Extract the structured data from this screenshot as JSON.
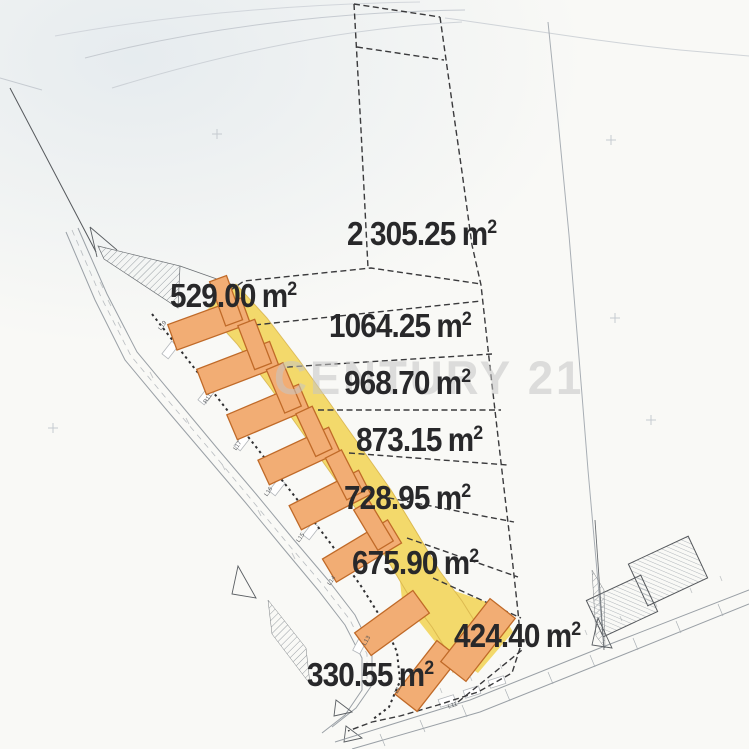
{
  "watermark": {
    "text": "CENTURY 21"
  },
  "units": {
    "base": "m",
    "exp": "2"
  },
  "parcels": [
    {
      "name": "parcel-2305",
      "area": "2 305.25"
    },
    {
      "name": "parcel-529",
      "area": "529.00"
    },
    {
      "name": "parcel-1064",
      "area": "1064.25"
    },
    {
      "name": "parcel-968",
      "area": "968.70"
    },
    {
      "name": "parcel-873",
      "area": "873.15"
    },
    {
      "name": "parcel-728",
      "area": "728.95"
    },
    {
      "name": "parcel-675",
      "area": "675.90"
    },
    {
      "name": "parcel-424",
      "area": "424.40"
    },
    {
      "name": "parcel-330",
      "area": "330.55"
    }
  ],
  "survey_points": [
    "L19",
    "R11",
    "L17",
    "L16",
    "L15",
    "L14",
    "L13",
    "L12",
    "L11"
  ],
  "colors": {
    "access_band": "#f3d96b",
    "band_edge": "#c79b36",
    "house_fill": "#f2ad74",
    "house_stroke": "#c06a28",
    "boundary": "#3a3a3c",
    "label_text": "#28282a",
    "watermark": "#c6c6c5"
  }
}
